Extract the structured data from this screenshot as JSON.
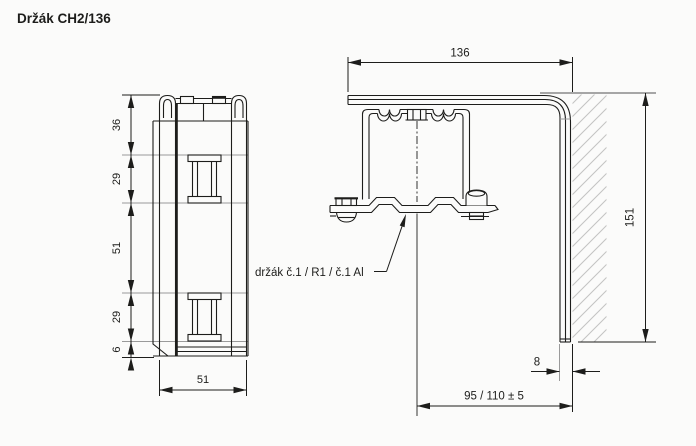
{
  "title": "Držák CH2/136",
  "drawing": {
    "part_label": "držák č.1 / R1 / č.1 Al",
    "side_view": {
      "chain": [
        "36",
        "29",
        "51",
        "29",
        "6"
      ],
      "width": "51"
    },
    "front_view": {
      "width": "136",
      "height": "151",
      "leg_thickness": "8",
      "mount_offset": "95 / 110 ± 5"
    },
    "colors": {
      "line": "#1d1d1b",
      "extension_line": "#9a9a9a",
      "hatch": "#c4c4c4",
      "background": "#fbfbfa"
    }
  }
}
